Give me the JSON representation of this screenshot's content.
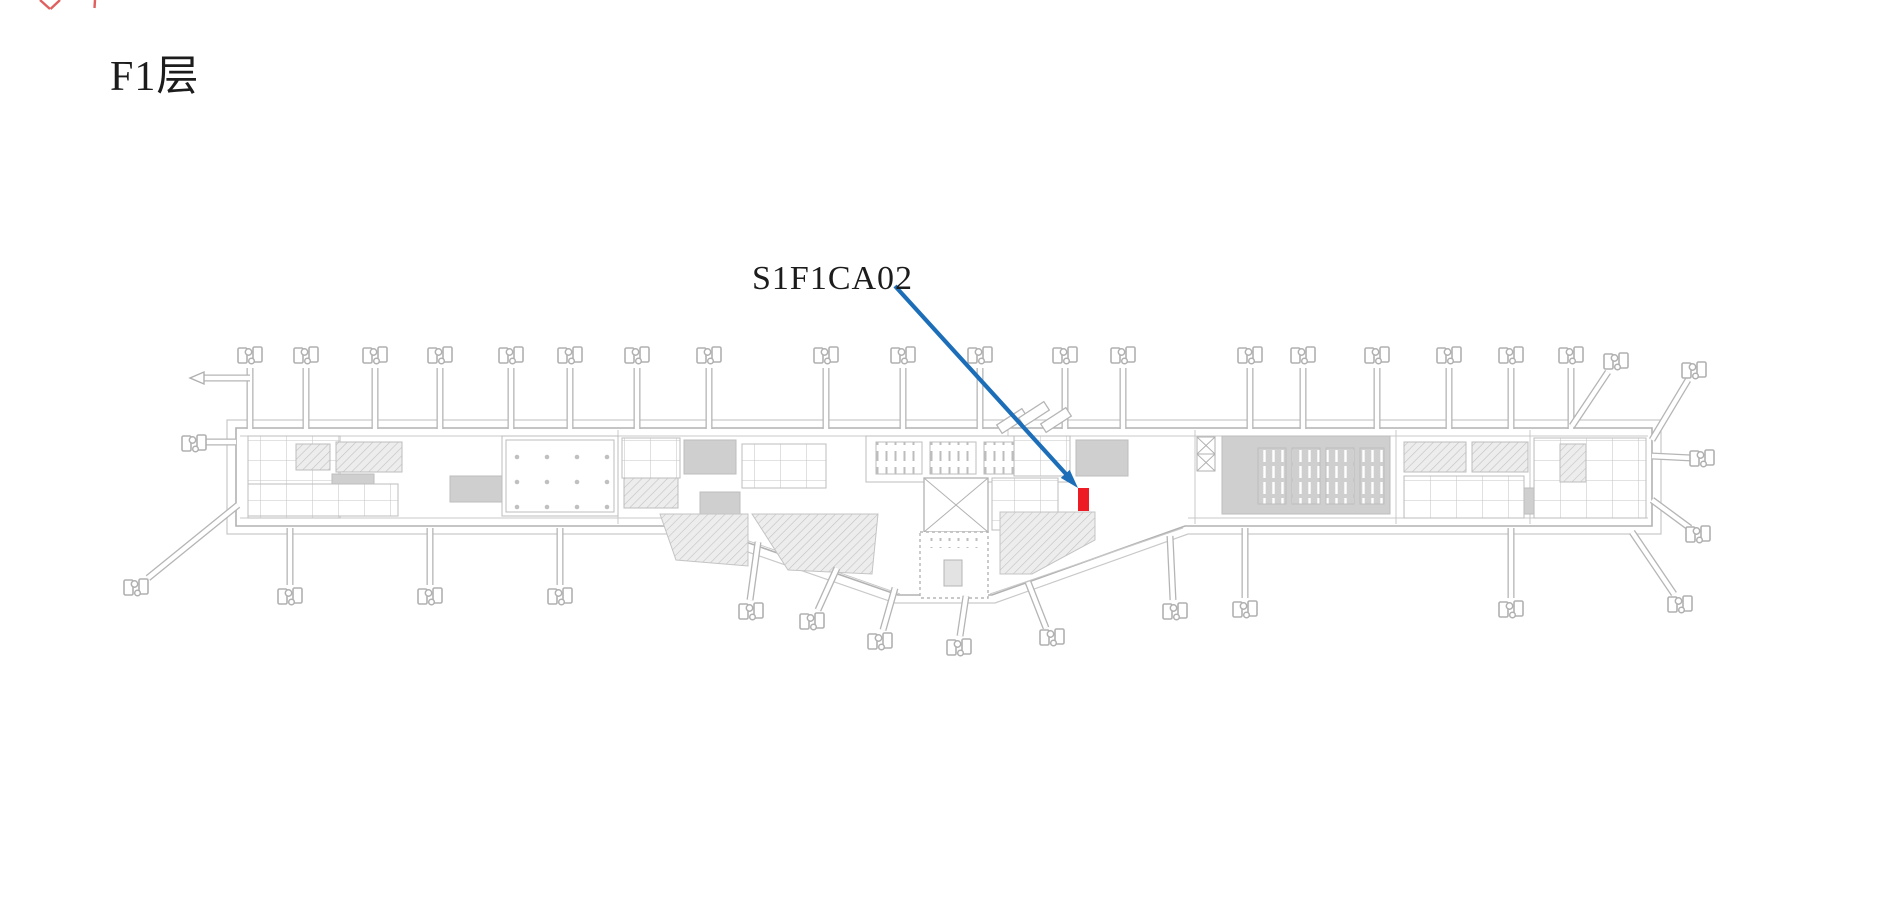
{
  "page": {
    "title": "F1层",
    "background_color": "#ffffff"
  },
  "callout": {
    "label": "S1F1CA02",
    "arrow_color": "#1c6eb8",
    "marker_color": "#ed1c24",
    "marker": {
      "x": 1078,
      "y": 488,
      "width": 11,
      "height": 23
    },
    "arrow": {
      "x1": 895,
      "y1": 286,
      "x2": 1066,
      "y2": 474
    },
    "arrowhead_points": "1078,488 1060.8,477.9 1069.7,469.9"
  },
  "floor_plan": {
    "description": "airport-terminal-level-1-plan",
    "wall_color": "#b2b2b2",
    "light_line_color": "#c8c8c8",
    "block_fill_color": "#cfcfcf"
  },
  "artifact": {
    "clipped_red_text_color": "#e06060"
  }
}
